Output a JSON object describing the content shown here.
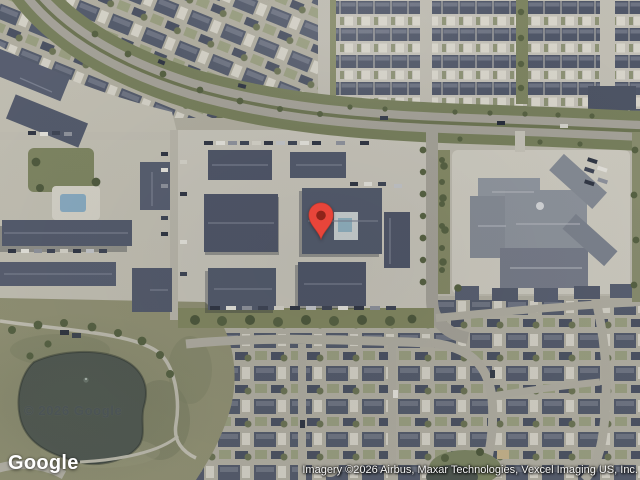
{
  "overlay": {
    "logo": "Google",
    "watermark": "© 2026 Google",
    "attribution": "Imagery ©2026 Airbus, Maxar Technologies, Vexcel Imaging US, Inc."
  },
  "pin": {
    "color": "#E8453A",
    "border_color": "#B5372C",
    "dot_color": "#8E241A"
  }
}
